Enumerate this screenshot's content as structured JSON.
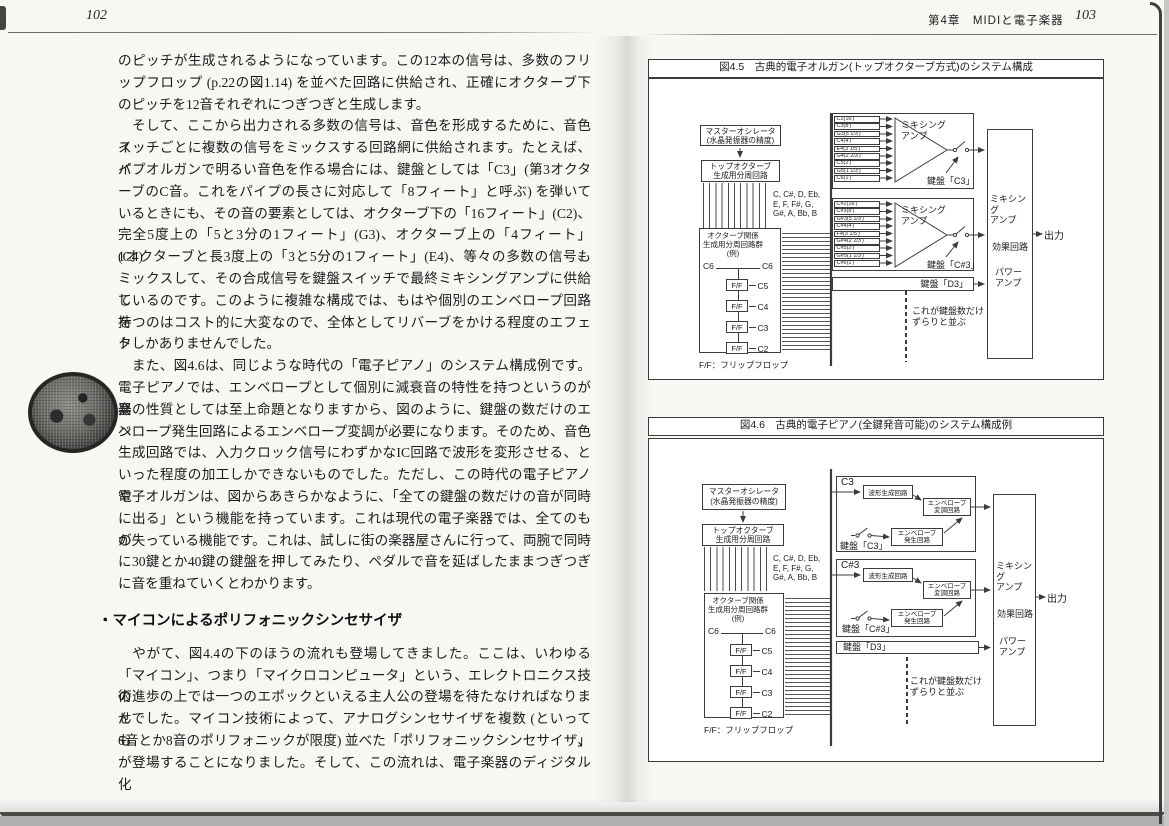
{
  "left_page": {
    "page_number": "102",
    "heading": "・マイコンによるポリフォニックシンセサイザ",
    "paragraphs": {
      "p1": [
        "のピッチが生成されるようになっています。この12本の信号は、多数のフリ",
        "ップフロップ (p.22の図1.14) を並べた回路に供給され、正確にオクターブ下",
        "のピッチを12音それぞれにつぎつぎと生成します。"
      ],
      "p2": [
        "　そして、ここから出力される多数の信号は、音色を形成するために、音色ス",
        "イッチごとに複数の信号をミックスする回路網に供給されます。たとえば、パ",
        "イプオルガンで明るい音色を作る場合には、鍵盤としては「C3」(第3オクタ",
        "ーブのC音。これをパイプの長さに対応して「8フィート」と呼ぶ) を弾いて",
        "いるときにも、その音の要素としては、オクターブ下の「16フィート」(C2)、",
        "完全5度上の「5と3分の1フィート」(G3)、オクターブ上の「4フィート」(C4)、",
        "1オクターブと長3度上の「3と5分の1フィート」(E4)、等々の多数の信号も",
        "ミックスして、その合成信号を鍵盤スイッチで最終ミキシングアンプに供給し",
        "ているのです。このように複雑な構成では、もはや個別のエンベロープ回路を",
        "持つのはコスト的に大変なので、全体としてリバーブをかける程度のエフェク",
        "トしかありませんでした。"
      ],
      "p3": [
        "　また、図4.6は、同じような時代の「電子ピアノ」のシステム構成例です。",
        "電子ピアノでは、エンベロープとして個別に減衰音の特性を持つというのが楽",
        "器の性質としては至上命題となりますから、図のように、鍵盤の数だけのエン",
        "ベロープ発生回路によるエンベロープ変調が必要になります。そのため、音色",
        "生成回路では、入力クロック信号にわずかなIC回路で波形を変形させる、と",
        "いった程度の加工しかできないものでした。ただし、この時代の電子ピアノや",
        "電子オルガンは、図からあきらかなように、「全ての鍵盤の数だけの音が同時",
        "に出る」という機能を持っています。これは現代の電子楽器では、全てのもの",
        "が失っている機能です。これは、試しに街の楽器屋さんに行って、両腕で同時",
        "に30鍵とか40鍵の鍵盤を押してみたり、ペダルで音を延ばしたままつぎつぎ",
        "に音を重ねていくとわかります。"
      ],
      "p4": [
        "　やがて、図4.4の下のほうの流れも登場してきました。ここは、いわゆる",
        "「マイコン」、つまり「マイクロコンピュータ」という、エレクトロニクス技術",
        "の進歩の上では一つのエポックといえる主人公の登場を待たなければなりませ",
        "んでした。マイコン技術によって、アナログシンセサイザを複数 (といっても、",
        "6音とか8音のポリフォニックが限度) 並べた「ポリフォニックシンセサイザ」",
        "が登場することになりました。そして、この流れは、電子楽器のディジタル化"
      ]
    }
  },
  "right_page": {
    "chapter_header": "第4章　MIDIと電子楽器",
    "page_number": "103",
    "fig45": {
      "title": "図4.5　古典的電子オルガン(トップオクターブ方式)のシステム構成",
      "master_osc": "マスターオシレータ\n(水晶発振器の精度)",
      "top_octave_divider": "トップオクターブ\n生成用分周回路",
      "note_names": "C, C#, D, Eb,\nE, F, F#, G,\nG#, A, Bb, B",
      "octave_divider_group": "オクターブ関係\n生成用分周回路群\n(例)",
      "ff_top_note": "C6",
      "ff_top_note_right": "C6",
      "ff_box": "F/F",
      "ff_chain": [
        "C5",
        "C4",
        "C3",
        "C2"
      ],
      "ff_caption": "F/F：フリップフロップ",
      "mixer1": {
        "signals": [
          "C2(16′)",
          "C3(8′)",
          "G3(5 1/3′)",
          "C4(4′)",
          "E4(3 1/5′)",
          "G4(2 2/3′)",
          "C5(2′)",
          "G5(1 1/3′)",
          "C6(1′)"
        ],
        "amp": "ミキシング\nアンプ",
        "key": "鍵盤「C3」"
      },
      "mixer2": {
        "signals": [
          "C#2(16′)",
          "C#3(8′)",
          "G#3(5 1/3′)",
          "C#4(4′)",
          "F4(3 1/5′)",
          "G#4(2 2/3′)",
          "C#5(2′)",
          "G#5(1 1/3′)",
          "C#6(1′)"
        ],
        "amp": "ミキシング\nアンプ",
        "key": "鍵盤「C#3」"
      },
      "key_d3": "鍵盤「D3」",
      "repeat_note": "これが鍵盤数だけ\nずらりと並ぶ",
      "mix_amp": "ミキシング\nアンプ",
      "effects": "効果回路",
      "power_amp": "パワー\nアンプ",
      "output": "出力"
    },
    "fig46": {
      "title": "図4.6　古典的電子ピアノ(全鍵発音可能)のシステム構成例",
      "master_osc": "マスターオシレータ\n(水晶発振器の精度)",
      "top_octave_divider": "トップオクターブ\n生成用分周回路",
      "note_names": "C, C#, D, Eb,\nE, F, F#, G,\nG#, A, Bb, B",
      "octave_divider_group": "オクターブ関係\n生成用分周回路群\n(例)",
      "ff_top_note": "C6",
      "ff_top_note_right": "C6",
      "ff_box": "F/F",
      "ff_chain": [
        "C5",
        "C4",
        "C3",
        "C2"
      ],
      "ff_caption": "F/F：フリップフロップ",
      "voice1": {
        "note": "C3",
        "wave": "波形生成回路",
        "env_mod": "エンベロープ\n変調回路",
        "env_gen": "エンベロープ\n発生回路",
        "key": "鍵盤「C3」"
      },
      "voice2": {
        "note": "C#3",
        "wave": "波形生成回路",
        "env_mod": "エンベロープ\n変調回路",
        "env_gen": "エンベロープ\n発生回路",
        "key": "鍵盤「C#3」"
      },
      "key_d3": "鍵盤「D3」",
      "repeat_note": "これが鍵盤数だけ\nずらりと並ぶ",
      "mix_amp": "ミキシング\nアンプ",
      "effects": "効果回路",
      "power_amp": "パワー\nアンプ",
      "output": "出力"
    }
  }
}
